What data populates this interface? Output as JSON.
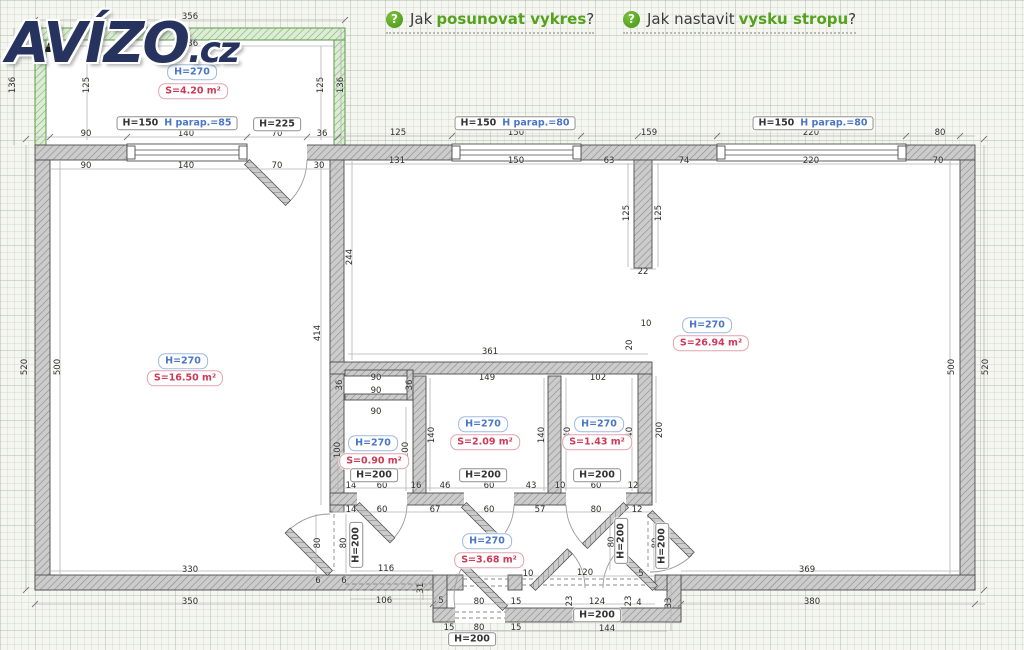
{
  "colors": {
    "accent_green": "#55a21e",
    "label_blue": "#4a76c8",
    "label_red": "#cc3a56",
    "logo_navy": "#26335f",
    "wall_fill": "#cccccc",
    "wall_hatch": "#8f8f8f",
    "balcony_fill": "#ddecd5",
    "balcony_hatch": "#7fb271"
  },
  "icons": {
    "question": "?",
    "north_triangle": "triangle-marker"
  },
  "logo": {
    "main": "AVÍZO",
    "suffix": ".cz"
  },
  "help_links": [
    {
      "prefix": "Jak",
      "bold": "posunovat vykres",
      "suffix": "?"
    },
    {
      "prefix": "Jak nastavit",
      "bold": "vysku stropu",
      "suffix": "?"
    }
  ],
  "plan": {
    "boxes": [
      {
        "k": "blue",
        "t": "H=270",
        "x": 192,
        "y": 72
      },
      {
        "k": "red",
        "t": "S=4.20 m²",
        "x": 193,
        "y": 91
      },
      {
        "k": "blue",
        "t": "H=270",
        "x": 183,
        "y": 361
      },
      {
        "k": "red",
        "t": "S=16.50 m²",
        "x": 185,
        "y": 378
      },
      {
        "k": "blue",
        "t": "H=270",
        "x": 373,
        "y": 443
      },
      {
        "k": "red",
        "t": "S=0.90 m²",
        "x": 374,
        "y": 461
      },
      {
        "k": "blue",
        "t": "H=270",
        "x": 483,
        "y": 424
      },
      {
        "k": "red",
        "t": "S=2.09 m²",
        "x": 485,
        "y": 442
      },
      {
        "k": "blue",
        "t": "H=270",
        "x": 599,
        "y": 424
      },
      {
        "k": "red",
        "t": "S=1.43 m²",
        "x": 597,
        "y": 442
      },
      {
        "k": "blue",
        "t": "H=270",
        "x": 707,
        "y": 325
      },
      {
        "k": "red",
        "t": "S=26.94 m²",
        "x": 711,
        "y": 343
      },
      {
        "k": "blue",
        "t": "H=270",
        "x": 487,
        "y": 541
      },
      {
        "k": "red",
        "t": "S=3.68 m²",
        "x": 489,
        "y": 560
      },
      {
        "k": "plain",
        "t": "H=225",
        "x": 277,
        "y": 124
      },
      {
        "k": "plain",
        "t": "H=200",
        "x": 374,
        "y": 475
      },
      {
        "k": "plain",
        "t": "H=200",
        "x": 483,
        "y": 475
      },
      {
        "k": "plain",
        "t": "H=200",
        "x": 597,
        "y": 475
      },
      {
        "k": "plain",
        "t": "H=200",
        "x": 472,
        "y": 639
      },
      {
        "k": "plain",
        "t": "H=200",
        "x": 597,
        "y": 615
      },
      {
        "k": "plain v",
        "t": "H=200",
        "x": 356,
        "y": 545
      },
      {
        "k": "plain v",
        "t": "H=200",
        "x": 621,
        "y": 541
      },
      {
        "k": "plain v",
        "t": "H=200",
        "x": 662,
        "y": 546
      },
      {
        "k": "window",
        "t": "H=150",
        "t2": "H parap.=85",
        "x": 177,
        "y": 123
      },
      {
        "k": "window",
        "t": "H=150",
        "t2": "H parap.=80",
        "x": 515,
        "y": 123
      },
      {
        "k": "window",
        "t": "H=150",
        "t2": "H parap.=80",
        "x": 813,
        "y": 123
      }
    ],
    "dims": [
      {
        "t": "356",
        "x": 190,
        "y": 17
      },
      {
        "t": "336",
        "x": 190,
        "y": 44
      },
      {
        "t": "136",
        "x": 13,
        "y": 85,
        "v": 1
      },
      {
        "t": "125",
        "x": 87,
        "y": 85,
        "v": 1
      },
      {
        "t": "125",
        "x": 321,
        "y": 85,
        "v": 1
      },
      {
        "t": "136",
        "x": 341,
        "y": 85,
        "v": 1
      },
      {
        "t": "90",
        "x": 86,
        "y": 134
      },
      {
        "t": "140",
        "x": 186,
        "y": 134
      },
      {
        "t": "70",
        "x": 277,
        "y": 134
      },
      {
        "t": "36",
        "x": 322,
        "y": 134
      },
      {
        "t": "90",
        "x": 86,
        "y": 166
      },
      {
        "t": "140",
        "x": 186,
        "y": 166
      },
      {
        "t": "70",
        "x": 277,
        "y": 166
      },
      {
        "t": "30",
        "x": 319,
        "y": 166
      },
      {
        "t": "125",
        "x": 398,
        "y": 133
      },
      {
        "t": "150",
        "x": 516,
        "y": 133
      },
      {
        "t": "159",
        "x": 649,
        "y": 133
      },
      {
        "t": "220",
        "x": 811,
        "y": 133
      },
      {
        "t": "80",
        "x": 940,
        "y": 133
      },
      {
        "t": "131",
        "x": 397,
        "y": 161
      },
      {
        "t": "150",
        "x": 516,
        "y": 161
      },
      {
        "t": "63",
        "x": 609,
        "y": 161
      },
      {
        "t": "74",
        "x": 684,
        "y": 161
      },
      {
        "t": "220",
        "x": 811,
        "y": 161
      },
      {
        "t": "70",
        "x": 938,
        "y": 161
      },
      {
        "t": "125",
        "x": 627,
        "y": 213,
        "v": 1
      },
      {
        "t": "125",
        "x": 659,
        "y": 213,
        "v": 1
      },
      {
        "t": "22",
        "x": 643,
        "y": 272
      },
      {
        "t": "520",
        "x": 25,
        "y": 367,
        "v": 1
      },
      {
        "t": "500",
        "x": 58,
        "y": 367,
        "v": 1
      },
      {
        "t": "500",
        "x": 952,
        "y": 367,
        "v": 1
      },
      {
        "t": "520",
        "x": 986,
        "y": 367,
        "v": 1
      },
      {
        "t": "244",
        "x": 350,
        "y": 257,
        "v": 1
      },
      {
        "t": "414",
        "x": 318,
        "y": 333,
        "v": 1
      },
      {
        "t": "361",
        "x": 490,
        "y": 352
      },
      {
        "t": "10",
        "x": 646,
        "y": 324
      },
      {
        "t": "20",
        "x": 630,
        "y": 345,
        "v": 1
      },
      {
        "t": "200",
        "x": 660,
        "y": 430,
        "v": 1
      },
      {
        "t": "36",
        "x": 340,
        "y": 385,
        "v": 1
      },
      {
        "t": "90",
        "x": 376,
        "y": 378
      },
      {
        "t": "90",
        "x": 376,
        "y": 391
      },
      {
        "t": "36",
        "x": 410,
        "y": 385,
        "v": 1
      },
      {
        "t": "90",
        "x": 376,
        "y": 412
      },
      {
        "t": "100",
        "x": 338,
        "y": 450,
        "v": 1
      },
      {
        "t": "100",
        "x": 406,
        "y": 450,
        "v": 1
      },
      {
        "t": "14",
        "x": 351,
        "y": 486
      },
      {
        "t": "60",
        "x": 382,
        "y": 486
      },
      {
        "t": "16",
        "x": 416,
        "y": 486
      },
      {
        "t": "149",
        "x": 487,
        "y": 378
      },
      {
        "t": "140",
        "x": 432,
        "y": 435,
        "v": 1
      },
      {
        "t": "140",
        "x": 542,
        "y": 435,
        "v": 1
      },
      {
        "t": "46",
        "x": 445,
        "y": 486
      },
      {
        "t": "60",
        "x": 489,
        "y": 486
      },
      {
        "t": "43",
        "x": 531,
        "y": 486
      },
      {
        "t": "102",
        "x": 598,
        "y": 378
      },
      {
        "t": "140",
        "x": 568,
        "y": 435,
        "v": 1
      },
      {
        "t": "140",
        "x": 630,
        "y": 435,
        "v": 1
      },
      {
        "t": "10",
        "x": 560,
        "y": 486
      },
      {
        "t": "60",
        "x": 596,
        "y": 486
      },
      {
        "t": "12",
        "x": 633,
        "y": 486
      },
      {
        "t": "14",
        "x": 351,
        "y": 510
      },
      {
        "t": "60",
        "x": 382,
        "y": 510
      },
      {
        "t": "67",
        "x": 435,
        "y": 510
      },
      {
        "t": "60",
        "x": 489,
        "y": 510
      },
      {
        "t": "57",
        "x": 540,
        "y": 510
      },
      {
        "t": "80",
        "x": 596,
        "y": 510
      },
      {
        "t": "12",
        "x": 637,
        "y": 510
      },
      {
        "t": "80",
        "x": 318,
        "y": 543,
        "v": 1
      },
      {
        "t": "80",
        "x": 344,
        "y": 543,
        "v": 1
      },
      {
        "t": "6",
        "x": 318,
        "y": 581
      },
      {
        "t": "6",
        "x": 344,
        "y": 581
      },
      {
        "t": "80",
        "x": 612,
        "y": 542,
        "v": 1
      },
      {
        "t": "80",
        "x": 656,
        "y": 543,
        "v": 1
      },
      {
        "t": "116",
        "x": 386,
        "y": 569
      },
      {
        "t": "106",
        "x": 384,
        "y": 601
      },
      {
        "t": "31",
        "x": 421,
        "y": 588,
        "v": 1
      },
      {
        "t": "5",
        "x": 441,
        "y": 601
      },
      {
        "t": "15",
        "x": 449,
        "y": 628
      },
      {
        "t": "80",
        "x": 479,
        "y": 602
      },
      {
        "t": "80",
        "x": 479,
        "y": 628
      },
      {
        "t": "15",
        "x": 516,
        "y": 602
      },
      {
        "t": "15",
        "x": 516,
        "y": 628
      },
      {
        "t": "10",
        "x": 528,
        "y": 574
      },
      {
        "t": "120",
        "x": 585,
        "y": 573
      },
      {
        "t": "5",
        "x": 641,
        "y": 574
      },
      {
        "t": "23",
        "x": 570,
        "y": 601,
        "v": 1
      },
      {
        "t": "124",
        "x": 597,
        "y": 602
      },
      {
        "t": "23",
        "x": 629,
        "y": 601,
        "v": 1
      },
      {
        "t": "4",
        "x": 639,
        "y": 603
      },
      {
        "t": "144",
        "x": 607,
        "y": 629
      },
      {
        "t": "33",
        "x": 669,
        "y": 603,
        "v": 1
      },
      {
        "t": "330",
        "x": 190,
        "y": 570
      },
      {
        "t": "350",
        "x": 190,
        "y": 602
      },
      {
        "t": "369",
        "x": 807,
        "y": 570
      },
      {
        "t": "380",
        "x": 812,
        "y": 602
      }
    ]
  }
}
